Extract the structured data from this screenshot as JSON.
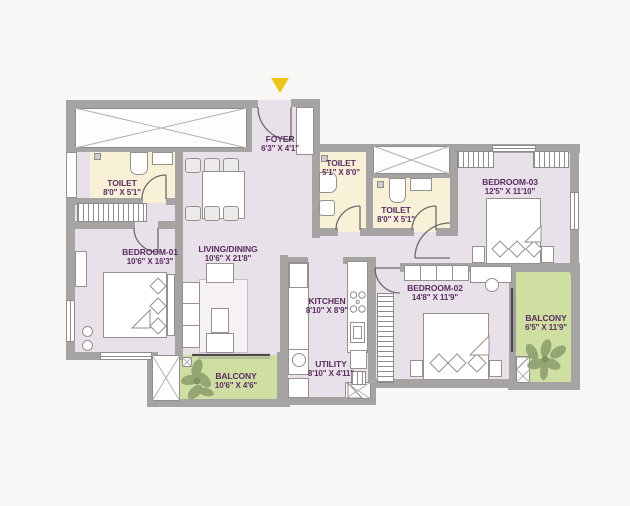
{
  "plan": {
    "type": "apartment-floor-plan",
    "colors": {
      "floor": "#e9e1e9",
      "toilet_floor": "#f8f1d8",
      "balcony_floor": "#cfdfa2",
      "wall": "#a6a4a3",
      "label_text": "#5b2c62",
      "entry_arrow": "#edc41d"
    },
    "entry": {
      "marker": "entry-arrow"
    },
    "rooms": [
      {
        "id": "foyer",
        "name": "FOYER",
        "dims": "6'3\" X 4'1\""
      },
      {
        "id": "toilet-1",
        "name": "TOILET",
        "dims": "8'0\" X 5'1\""
      },
      {
        "id": "toilet-2",
        "name": "TOILET",
        "dims": "5'1\" X 8'0\""
      },
      {
        "id": "toilet-3",
        "name": "TOILET",
        "dims": "8'0\" X 5'1\""
      },
      {
        "id": "bedroom-01",
        "name": "BEDROOM-01",
        "dims": "10'6\" X 16'3\""
      },
      {
        "id": "living-dining",
        "name": "LIVING/DINING",
        "dims": "10'6\" X 21'8\""
      },
      {
        "id": "bedroom-03",
        "name": "BEDROOM-03",
        "dims": "12'5\" X 11'10\""
      },
      {
        "id": "kitchen",
        "name": "KITCHEN",
        "dims": "8'10\" X 8'9\""
      },
      {
        "id": "bedroom-02",
        "name": "BEDROOM-02",
        "dims": "14'8\" X 11'9\""
      },
      {
        "id": "utility",
        "name": "UTILITY",
        "dims": "8'10\" X 4'11\""
      },
      {
        "id": "balcony-1",
        "name": "BALCONY",
        "dims": "10'6\" X 4'6\""
      },
      {
        "id": "balcony-2",
        "name": "BALCONY",
        "dims": "6'5\" X 11'9\""
      }
    ]
  }
}
